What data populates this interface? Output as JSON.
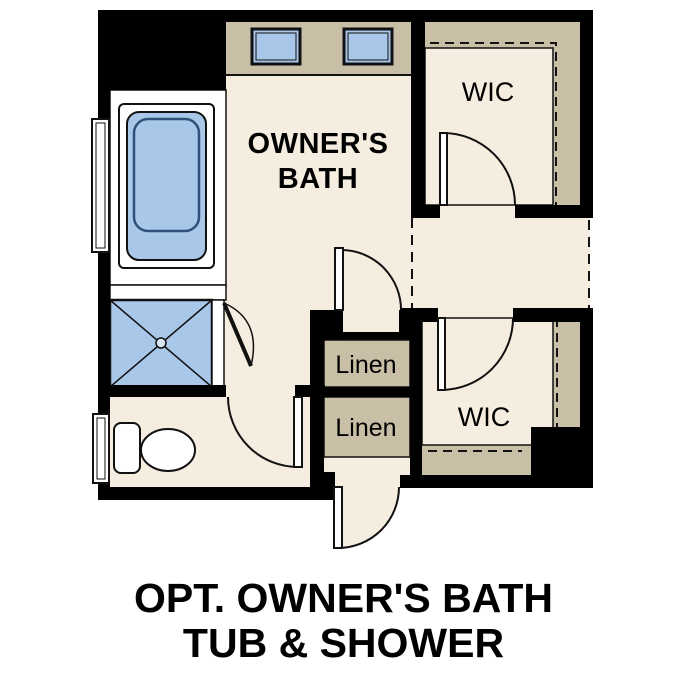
{
  "title": {
    "line1": "OPT. OWNER'S BATH",
    "line2": "TUB & SHOWER"
  },
  "labels": {
    "owners_bath_line1": "OWNER'S",
    "owners_bath_line2": "BATH",
    "wic_upper": "WIC",
    "wic_lower": "WIC",
    "linen_upper": "Linen",
    "linen_lower": "Linen"
  },
  "fixtures": [
    "vanity-sink-left",
    "vanity-sink-right",
    "bathtub",
    "shower",
    "toilet",
    "window-upper",
    "window-lower",
    "linen-closet-upper",
    "linen-closet-lower",
    "walk-in-closet-upper",
    "walk-in-closet-lower"
  ],
  "colors": {
    "wall": "#000000",
    "floor": "#f5eee0",
    "casework": "#c9bea6",
    "fixture_blue": "#a9c8e9",
    "line": "#111111",
    "text": "#000000",
    "background": "#ffffff"
  }
}
